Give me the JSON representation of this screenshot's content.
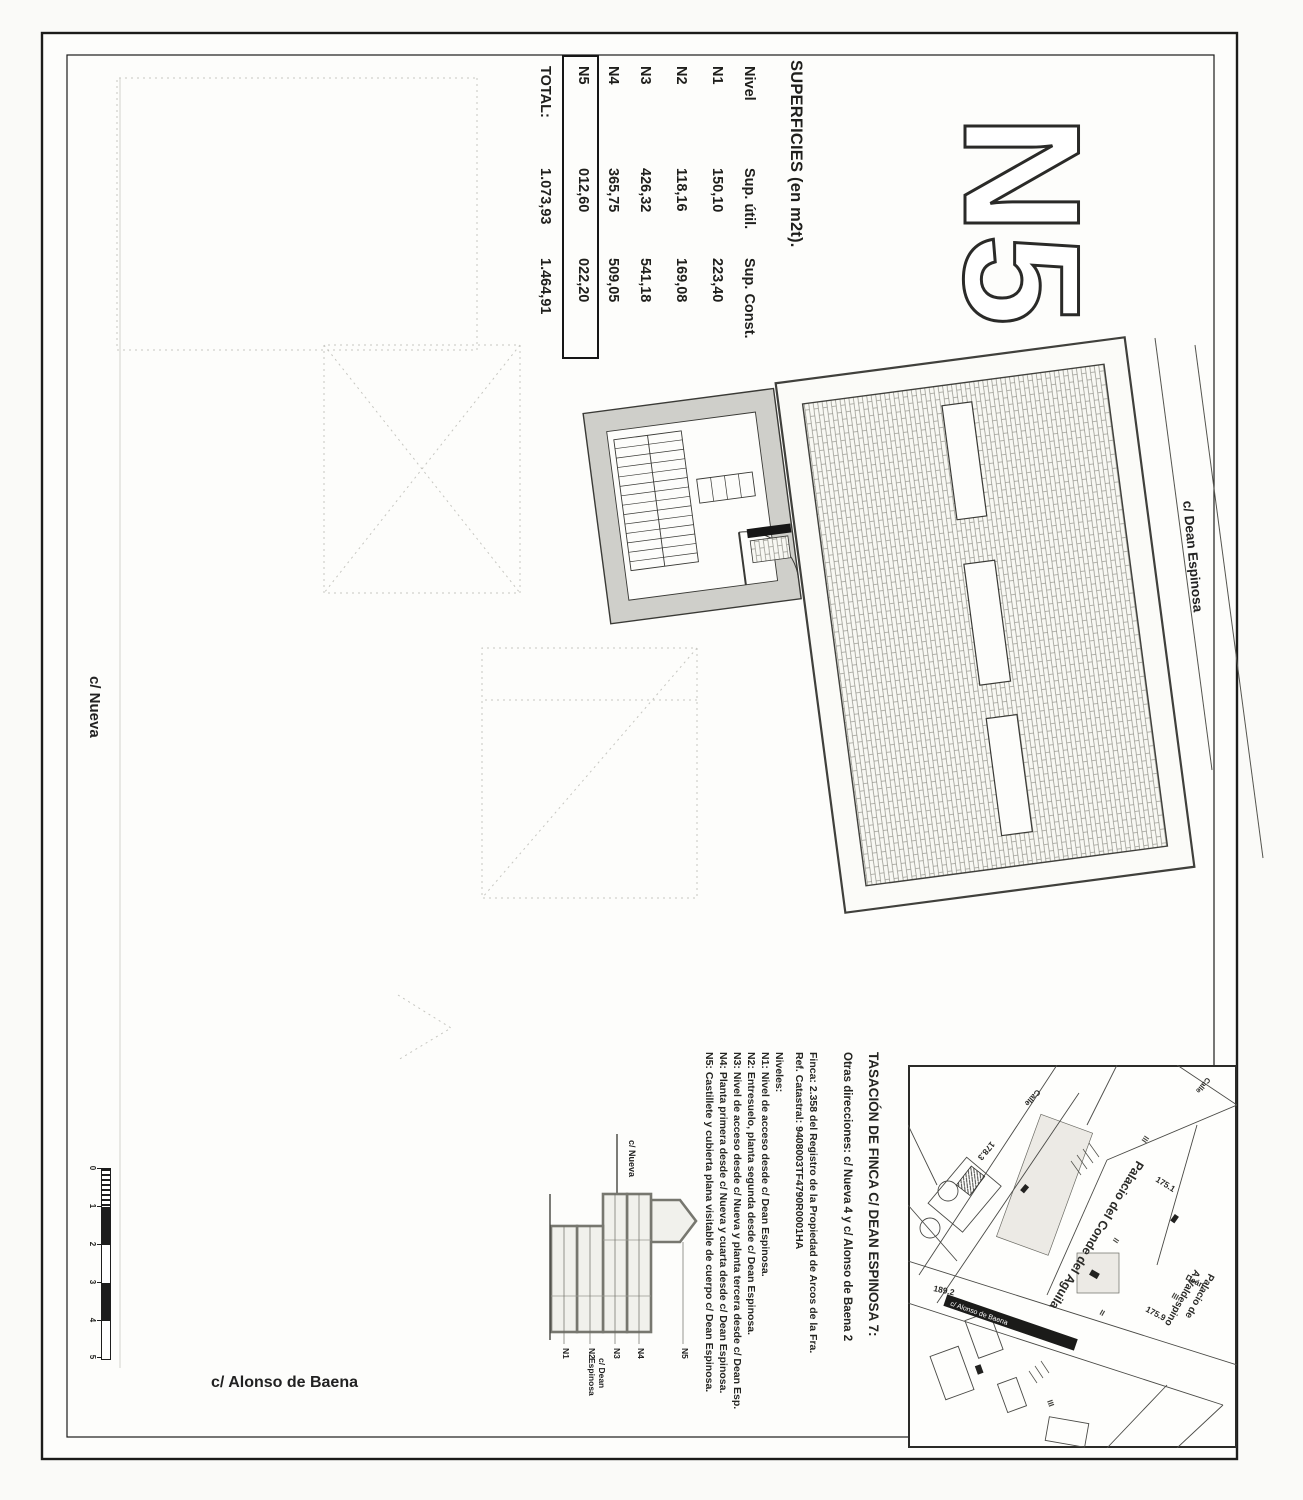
{
  "colors": {
    "paper": "#fdfdfb",
    "ink": "#1f1f1c"
  },
  "sheet": {
    "plan_label": "N5",
    "streets": {
      "dean": "c/ Dean Espinosa",
      "nueva": "c/ Nueva",
      "alonso": "c/ Alonso de Baena"
    }
  },
  "superficies_table": {
    "title": "SUPERFICIES (en m2t).",
    "columns": [
      "Nivel",
      "Sup. útil.",
      "Sup. Const."
    ],
    "rows": [
      {
        "nivel": "N1",
        "util": "150,10",
        "const": "223,40"
      },
      {
        "nivel": "N2",
        "util": "118,16",
        "const": "169,08"
      },
      {
        "nivel": "N3",
        "util": "426,32",
        "const": "541,18"
      },
      {
        "nivel": "N4",
        "util": "365,75",
        "const": "509,05"
      },
      {
        "nivel": "N5",
        "util": "012,60",
        "const": "022,20"
      }
    ],
    "total": {
      "label": "TOTAL:",
      "util": "1.073,93",
      "const": "1.464,91"
    }
  },
  "notes": {
    "title": "TASACIÓN DE FINCA C/ DEAN ESPINOSA 7:",
    "line2": "Otras direcciones: c/ Nueva 4 y c/ Alonso de Baena 2",
    "finca": "Finca: 2.358 del Registro de la Propiedad de Arcos de la Fra.",
    "catastral": "Ref. Catastral: 9408003TF4790R0001HA",
    "niveles_label": "Niveles:",
    "niveles": [
      "N1: Nivel de acceso desde c/ Dean Espinosa.",
      "N2: Entresuelo, planta segunda desde c/ Dean Espinosa.",
      "N3: Nivel de acceso desde c/ Nueva y planta tercera desde c/ Dean Esp.",
      "N4: Planta primera desde c/ Nueva y cuarta desde c/ Dean Espinosa.",
      "N5: Castillete y cubierta plana visitable de cuerpo c/ Dean Espinosa."
    ]
  },
  "section": {
    "labels": [
      "N5",
      "N4",
      "N3",
      "N2",
      "N1"
    ],
    "street_top": "c/ Nueva",
    "street_bottom": "c/ Dean Espinosa"
  },
  "map": {
    "labels": {
      "palacio_conde": "Palacio del Conde del Aguila",
      "palacio_valdespino_1": "Palacio de",
      "palacio_valdespino_2": "A.Valdespino",
      "calle1": "Calle",
      "calle2": "Calle",
      "dean": "Deán",
      "banner": "c/ Alonso de Baena"
    },
    "elevations": [
      "175.1",
      "175.9",
      "178.3",
      "189.2"
    ],
    "marks": [
      "III",
      "II",
      "III",
      "II",
      "III"
    ]
  },
  "scalebar": {
    "ticks": [
      "0",
      "1",
      "2",
      "3",
      "4",
      "5"
    ]
  }
}
